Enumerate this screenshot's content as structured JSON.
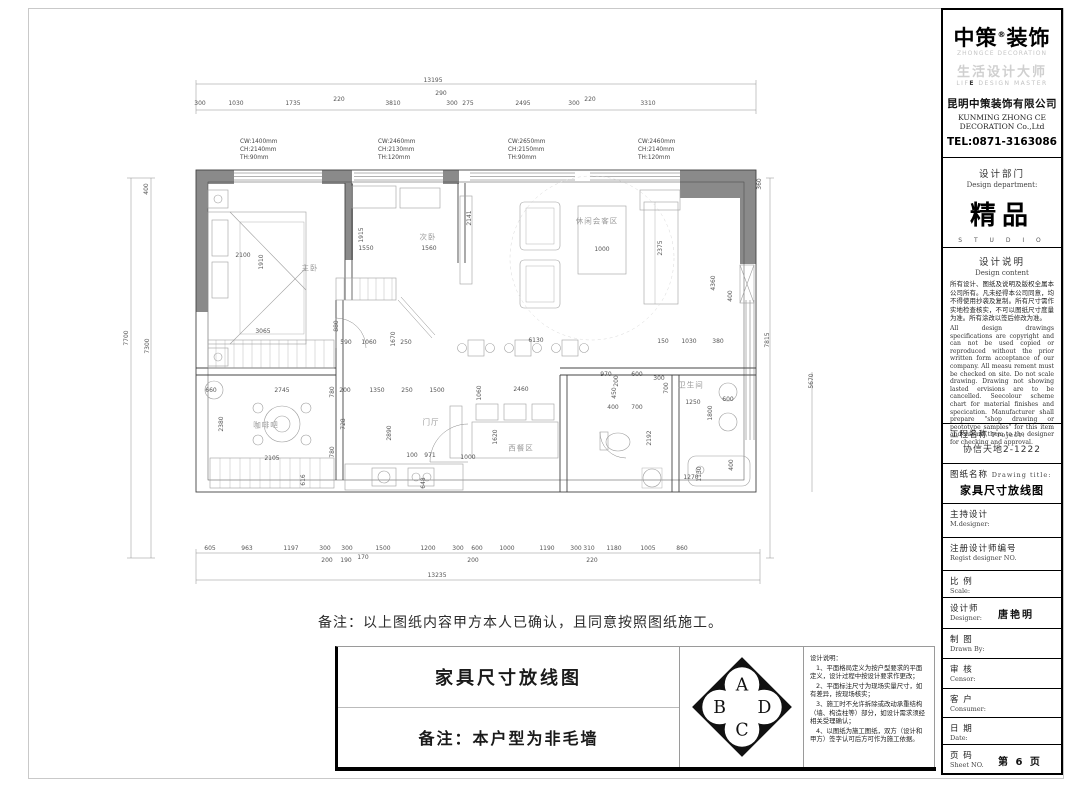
{
  "title_block": {
    "logo": {
      "brand1": "中策",
      "reg": "®",
      "brand2": "装饰",
      "sub_en": "ZHONGCE DECORATION",
      "slogan_cn": "生活设计大师",
      "slogan_en_b": "E",
      "slogan_en": "LIF",
      "slogan_en2": " DESIGN MASTER",
      "company_cn": "昆明中策装饰有限公司",
      "company_en1": "KUNMING ZHONG CE",
      "company_en2": "DECORATION Co.,Ltd",
      "tel": "TEL:0871-3163086"
    },
    "department": {
      "label_cn": "设计部门",
      "label_en": "Design department:",
      "value": "精品",
      "value_sub": "S T U D I O"
    },
    "design_notes": {
      "label_cn": "设计说明",
      "label_en": "Design content",
      "cn": "所有设计、图纸及说明及版权全属本公司所有。凡未经得本公司同意，均不得使用抄袭及复制。所有尺寸需作实地检查核实，不可以图纸尺寸度量为准。所有涂改以签后修改为准。",
      "en": "All design drawings specifications are copyright and can not be used copied or reproduced without the prior written form acceptance of our company. All measu rement must be checked on site. Do not scale drawing. Drawing not showing lasted ervisions are to be cancelled. Seecolour scheme chart for material finishes and specication. Manufacturer shall prepare \"shop drawing or peototype samples\" for this item and submit them to the designer for checking and approval."
    },
    "project": {
      "label_cn": "工程名称",
      "label_en": "Project:",
      "value": "协信天地2-1222"
    },
    "drawing": {
      "label_cn": "图纸名称",
      "label_en": "Drawing title:",
      "value": "家具尺寸放线图"
    },
    "fields": [
      {
        "name": "m-designer",
        "cn": "主持设计",
        "en": "M.designer:",
        "value": "",
        "h": 34
      },
      {
        "name": "regist-no",
        "cn": "注册设计师编号",
        "en": "Regist designer NO.",
        "value": "",
        "h": 33
      },
      {
        "name": "scale",
        "cn": "比 例",
        "en": "Scale:",
        "value": "",
        "h": 27
      },
      {
        "name": "designer",
        "cn": "设计师",
        "en": "Designer:",
        "value": "唐艳明",
        "h": 31
      },
      {
        "name": "drawn-by",
        "cn": "制 图",
        "en": "Drawn By:",
        "value": "",
        "h": 30
      },
      {
        "name": "censor",
        "cn": "审 核",
        "en": "Censor:",
        "value": "",
        "h": 30
      },
      {
        "name": "consumer",
        "cn": "客 户",
        "en": "Consumer:",
        "value": "",
        "h": 29
      },
      {
        "name": "date",
        "cn": "日 期",
        "en": "Date:",
        "value": "",
        "h": 27
      },
      {
        "name": "sheet-no",
        "cn": "页 码",
        "en": "Sheet NO.",
        "value": "第 6 页",
        "h": 27
      }
    ]
  },
  "confirmation_note": "备注：以上图纸内容甲方本人已确认，且同意按照图纸施工。",
  "bottom_bar": {
    "drawing_title": "家具尺寸放线图",
    "remark": "备注：本户型为非毛墙",
    "compass": {
      "top": "A",
      "left": "B",
      "right": "D",
      "bottom": "C"
    },
    "notes_title": "设计说明：",
    "notes": [
      "1、平面格局定义为按户型要求的平面定义，设计过程中按设计要求作更改；",
      "2、平面标注尺寸为现场实量尺寸，如有差异，按现场核实；",
      "3、施工时不允许拆除或改动承重结构（墙、构造柱等）部分，如设计需求须经相关受理确认；",
      "4、以图纸为施工图纸，双方（设计和甲方）签字认可后方可作为施工依据。"
    ]
  },
  "plan": {
    "room_labels": [
      {
        "t": "主卧",
        "x": 310,
        "y": 268
      },
      {
        "t": "次卧",
        "x": 428,
        "y": 237
      },
      {
        "t": "休闲会客区",
        "x": 597,
        "y": 221
      },
      {
        "t": "门厅",
        "x": 431,
        "y": 422
      },
      {
        "t": "西餐区",
        "x": 521,
        "y": 448
      },
      {
        "t": "卫生间",
        "x": 691,
        "y": 385
      },
      {
        "t": "咖啡吧",
        "x": 266,
        "y": 425
      }
    ],
    "window_notes": [
      {
        "x": 240,
        "y": 138,
        "lines": [
          "CW:1400mm",
          "CH:2140mm",
          "TH:90mm"
        ]
      },
      {
        "x": 378,
        "y": 138,
        "lines": [
          "CW:2460mm",
          "CH:2130mm",
          "TH:120mm"
        ]
      },
      {
        "x": 508,
        "y": 138,
        "lines": [
          "CW:2650mm",
          "CH:2150mm",
          "TH:90mm"
        ]
      },
      {
        "x": 638,
        "y": 138,
        "lines": [
          "CW:2460mm",
          "CH:2140mm",
          "TH:120mm"
        ]
      }
    ],
    "dim_labels": [
      {
        "t": "13195",
        "x": 433,
        "y": 81
      },
      {
        "t": "290",
        "x": 441,
        "y": 94
      },
      {
        "t": "300",
        "x": 200,
        "y": 104
      },
      {
        "t": "1030",
        "x": 236,
        "y": 104
      },
      {
        "t": "1735",
        "x": 293,
        "y": 104
      },
      {
        "t": "220",
        "x": 339,
        "y": 100
      },
      {
        "t": "3810",
        "x": 393,
        "y": 104
      },
      {
        "t": "300",
        "x": 452,
        "y": 104
      },
      {
        "t": "275",
        "x": 468,
        "y": 104
      },
      {
        "t": "2495",
        "x": 523,
        "y": 104
      },
      {
        "t": "300",
        "x": 574,
        "y": 104
      },
      {
        "t": "220",
        "x": 590,
        "y": 100
      },
      {
        "t": "3310",
        "x": 648,
        "y": 104
      },
      {
        "t": "400",
        "x": 147,
        "y": 189,
        "r": 1
      },
      {
        "t": "7700",
        "x": 127,
        "y": 338,
        "r": 1
      },
      {
        "t": "7300",
        "x": 148,
        "y": 346,
        "r": 1
      },
      {
        "t": "360",
        "x": 760,
        "y": 184,
        "r": 1
      },
      {
        "t": "7815",
        "x": 768,
        "y": 340,
        "r": 1
      },
      {
        "t": "5670",
        "x": 812,
        "y": 381,
        "r": 1
      },
      {
        "t": "605",
        "x": 210,
        "y": 549
      },
      {
        "t": "963",
        "x": 247,
        "y": 549
      },
      {
        "t": "1197",
        "x": 291,
        "y": 549
      },
      {
        "t": "300",
        "x": 325,
        "y": 549
      },
      {
        "t": "200",
        "x": 327,
        "y": 561
      },
      {
        "t": "300",
        "x": 347,
        "y": 549
      },
      {
        "t": "190",
        "x": 346,
        "y": 561
      },
      {
        "t": "170",
        "x": 363,
        "y": 558
      },
      {
        "t": "1500",
        "x": 383,
        "y": 549
      },
      {
        "t": "1200",
        "x": 428,
        "y": 549
      },
      {
        "t": "300",
        "x": 458,
        "y": 549
      },
      {
        "t": "600",
        "x": 477,
        "y": 549
      },
      {
        "t": "200",
        "x": 473,
        "y": 561
      },
      {
        "t": "1000",
        "x": 507,
        "y": 549
      },
      {
        "t": "1190",
        "x": 547,
        "y": 549
      },
      {
        "t": "300",
        "x": 576,
        "y": 549
      },
      {
        "t": "310",
        "x": 589,
        "y": 549
      },
      {
        "t": "220",
        "x": 592,
        "y": 561
      },
      {
        "t": "1180",
        "x": 614,
        "y": 549
      },
      {
        "t": "1005",
        "x": 648,
        "y": 549
      },
      {
        "t": "860",
        "x": 682,
        "y": 549
      },
      {
        "t": "13235",
        "x": 437,
        "y": 576
      },
      {
        "t": "2100",
        "x": 243,
        "y": 256
      },
      {
        "t": "1910",
        "x": 262,
        "y": 262,
        "r": 1
      },
      {
        "t": "3065",
        "x": 263,
        "y": 332
      },
      {
        "t": "1915",
        "x": 362,
        "y": 235,
        "r": 1
      },
      {
        "t": "1550",
        "x": 366,
        "y": 249
      },
      {
        "t": "1560",
        "x": 429,
        "y": 249
      },
      {
        "t": "880",
        "x": 337,
        "y": 326,
        "r": 1
      },
      {
        "t": "590",
        "x": 346,
        "y": 343
      },
      {
        "t": "1060",
        "x": 369,
        "y": 343
      },
      {
        "t": "1670",
        "x": 394,
        "y": 339,
        "r": 1
      },
      {
        "t": "250",
        "x": 406,
        "y": 343
      },
      {
        "t": "2141",
        "x": 470,
        "y": 218,
        "r": 1
      },
      {
        "t": "1000",
        "x": 602,
        "y": 250
      },
      {
        "t": "2375",
        "x": 661,
        "y": 248,
        "r": 1
      },
      {
        "t": "4360",
        "x": 714,
        "y": 283,
        "r": 1
      },
      {
        "t": "400",
        "x": 731,
        "y": 296,
        "r": 1
      },
      {
        "t": "6130",
        "x": 536,
        "y": 341
      },
      {
        "t": "150",
        "x": 663,
        "y": 342
      },
      {
        "t": "1030",
        "x": 689,
        "y": 342
      },
      {
        "t": "380",
        "x": 718,
        "y": 342
      },
      {
        "t": "660",
        "x": 211,
        "y": 391
      },
      {
        "t": "2745",
        "x": 282,
        "y": 391
      },
      {
        "t": "2380",
        "x": 222,
        "y": 424,
        "r": 1
      },
      {
        "t": "780",
        "x": 333,
        "y": 392,
        "r": 1
      },
      {
        "t": "200",
        "x": 345,
        "y": 391
      },
      {
        "t": "1350",
        "x": 377,
        "y": 391
      },
      {
        "t": "250",
        "x": 407,
        "y": 391
      },
      {
        "t": "1500",
        "x": 437,
        "y": 391
      },
      {
        "t": "728",
        "x": 344,
        "y": 424,
        "r": 1
      },
      {
        "t": "2105",
        "x": 272,
        "y": 459
      },
      {
        "t": "780",
        "x": 333,
        "y": 452,
        "r": 1
      },
      {
        "t": "616",
        "x": 304,
        "y": 480,
        "r": 1
      },
      {
        "t": "2890",
        "x": 390,
        "y": 433,
        "r": 1
      },
      {
        "t": "100",
        "x": 412,
        "y": 456
      },
      {
        "t": "971",
        "x": 430,
        "y": 456
      },
      {
        "t": "648",
        "x": 424,
        "y": 483,
        "r": 1
      },
      {
        "t": "1060",
        "x": 480,
        "y": 393,
        "r": 1
      },
      {
        "t": "2460",
        "x": 521,
        "y": 390
      },
      {
        "t": "1620",
        "x": 496,
        "y": 437,
        "r": 1
      },
      {
        "t": "1000",
        "x": 468,
        "y": 458
      },
      {
        "t": "970",
        "x": 606,
        "y": 375
      },
      {
        "t": "600",
        "x": 637,
        "y": 375
      },
      {
        "t": "200",
        "x": 617,
        "y": 381,
        "r": 1
      },
      {
        "t": "300",
        "x": 659,
        "y": 379
      },
      {
        "t": "700",
        "x": 667,
        "y": 388,
        "r": 1
      },
      {
        "t": "450",
        "x": 615,
        "y": 393,
        "r": 1
      },
      {
        "t": "400",
        "x": 613,
        "y": 408
      },
      {
        "t": "700",
        "x": 637,
        "y": 408
      },
      {
        "t": "1250",
        "x": 693,
        "y": 403
      },
      {
        "t": "600",
        "x": 728,
        "y": 400
      },
      {
        "t": "1800",
        "x": 711,
        "y": 413,
        "r": 1
      },
      {
        "t": "2192",
        "x": 650,
        "y": 438,
        "r": 1
      },
      {
        "t": "1270",
        "x": 691,
        "y": 478
      },
      {
        "t": "1130",
        "x": 700,
        "y": 474,
        "r": 1
      },
      {
        "t": "400",
        "x": 732,
        "y": 465,
        "r": 1
      }
    ],
    "colors": {
      "wall_fill": "#8a8a8a",
      "line": "#444444",
      "furniture": "#9e9e9e",
      "dim_text": "#555555"
    }
  }
}
